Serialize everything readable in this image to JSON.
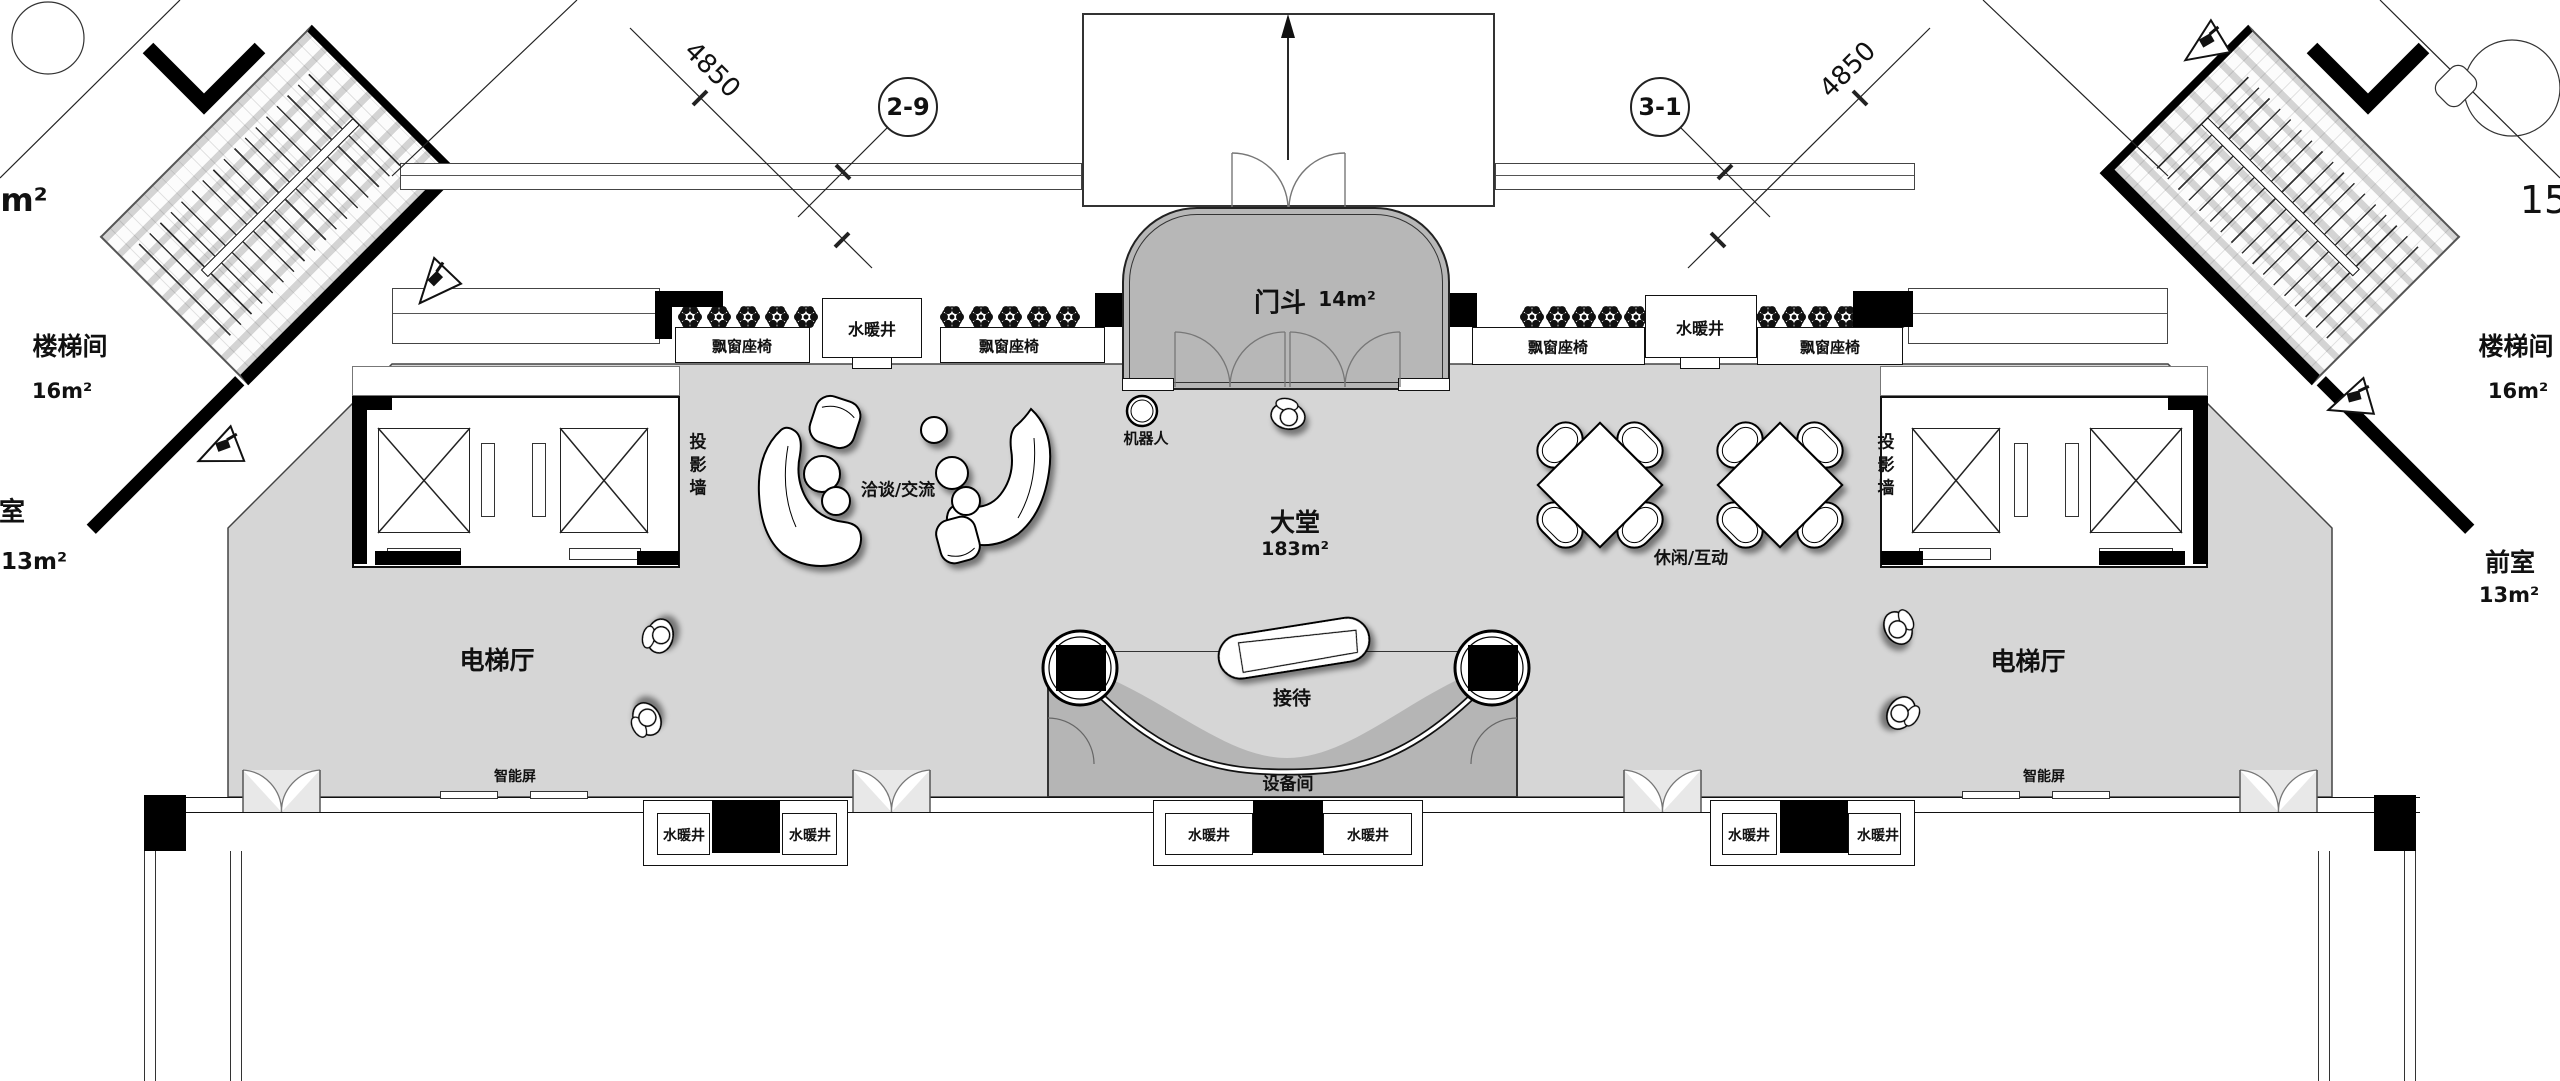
{
  "header": {
    "dim_left": "4850",
    "dim_right": "4850",
    "bubble_left": "2-9",
    "bubble_right": "3-1"
  },
  "rooms": {
    "vestibule_name": "门斗",
    "vestibule_area": "14m²",
    "lobby_name": "大堂",
    "lobby_area": "183m²",
    "elevator_hall": "电梯厅",
    "stairwell_name": "楼梯间",
    "stairwell_area": "16m²",
    "front_room_name": "前室",
    "front_room_area": "13m²",
    "front_room_left_partial": "室",
    "partial_area_left": "m²",
    "partial_right": "15",
    "equipment_room": "设备间"
  },
  "labels": {
    "bay_window_seat": "飘窗座椅",
    "plumbing_shaft": "水暖井",
    "projection_wall": "投影墙",
    "robot": "机器人",
    "reception": "接待",
    "smart_screen": "智能屏",
    "negotiation": "洽谈/交流",
    "leisure": "休闲/互动"
  },
  "colors": {
    "floor": "#d6d6d6",
    "vestibule": "#b7b7b7",
    "equipment": "#b5b5b5",
    "wall": "#111111",
    "door_fill": "#e8e8e8"
  }
}
